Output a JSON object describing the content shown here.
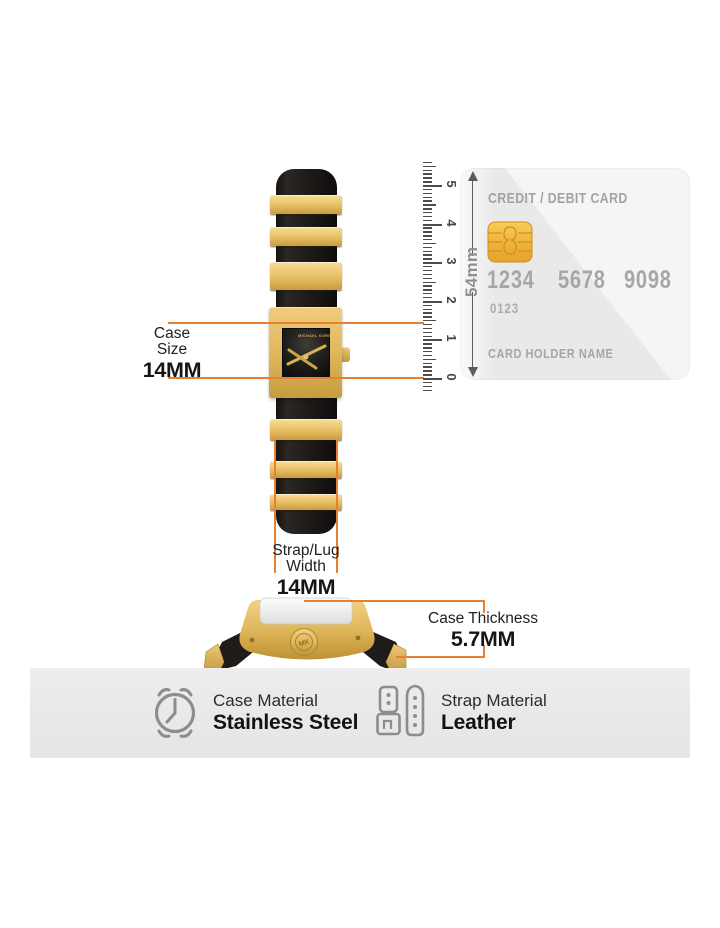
{
  "colors": {
    "accent_orange": "#E8802F",
    "gold": "#E2BA60",
    "strap_black": "#1d1a18",
    "card_bg": "#E9E9E9",
    "card_text": "#A6A6A6",
    "band_bg": "#E9E9E9",
    "icon_gray": "#8D8D8D",
    "text_dark": "#232021"
  },
  "watch": {
    "brand": "MICHAEL KORS",
    "crown_logo": "MK"
  },
  "ruler": {
    "numbers": [
      "0",
      "1",
      "2",
      "3",
      "4",
      "5"
    ]
  },
  "card": {
    "title": "CREDIT / DEBIT CARD",
    "number_groups": [
      "1234",
      "5678",
      "9098"
    ],
    "small_number": "0123",
    "holder_label": "CARD HOLDER NAME",
    "height_label": "54mm"
  },
  "annotations": {
    "case_size": {
      "label_line1": "Case",
      "label_line2": "Size",
      "value": "14MM"
    },
    "strap_width": {
      "label_line1": "Strap/Lug",
      "label_line2": "Width",
      "value": "14MM"
    },
    "case_thickness": {
      "label": "Case Thickness",
      "value": "5.7MM"
    }
  },
  "materials": [
    {
      "label": "Case Material",
      "value": "Stainless Steel"
    },
    {
      "label": "Strap Material",
      "value": "Leather"
    }
  ]
}
